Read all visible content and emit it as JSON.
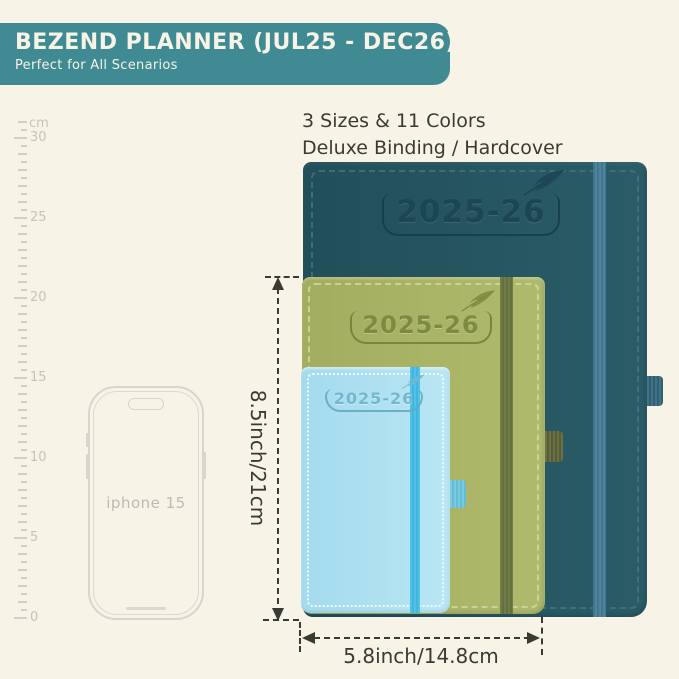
{
  "banner": {
    "title": "BEZEND PLANNER (JUL25 - DEC26)",
    "subtitle": "Perfect for All Scenarios",
    "bg_color": "#3f8a93",
    "text_color": "#f7f3e6"
  },
  "note": {
    "line1": "3 Sizes & 11 Colors",
    "line2": "Deluxe Binding / Hardcover"
  },
  "ruler": {
    "unit": "cm",
    "labels": [
      {
        "cm": 30,
        "text": "30"
      },
      {
        "cm": 25,
        "text": "25"
      },
      {
        "cm": 20,
        "text": "20"
      },
      {
        "cm": 15,
        "text": "15"
      },
      {
        "cm": 10,
        "text": "10"
      },
      {
        "cm": 5,
        "text": "5"
      },
      {
        "cm": 0,
        "text": "0"
      }
    ],
    "max_cm": 31,
    "px_per_cm": 16,
    "zero_y": 618
  },
  "phone": {
    "label": "iphone 15"
  },
  "planners": [
    {
      "size": "large",
      "year": "2025-26",
      "cover_color": "#265763",
      "band_color": "#41768e"
    },
    {
      "size": "medium",
      "year": "2025-26",
      "cover_color": "#a9b365",
      "band_color": "#6f7d48"
    },
    {
      "size": "small",
      "year": "2025-26",
      "cover_color": "#a9def0",
      "band_color": "#4ec3e9"
    }
  ],
  "dimensions": {
    "height_label": "8.5inch/21cm",
    "width_label": "5.8inch/14.8cm"
  }
}
